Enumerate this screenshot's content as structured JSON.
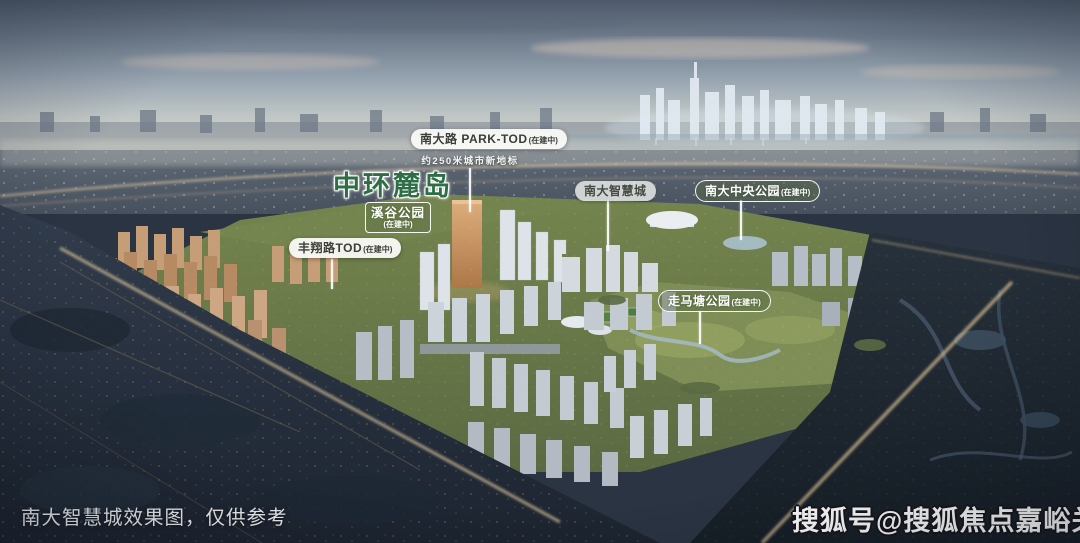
{
  "scene": {
    "caption": "南大智慧城效果图，仅供参考",
    "watermark": "搜狐号@搜狐焦点嘉峪关站"
  },
  "labels": {
    "park_tod": {
      "title": "南大路 PARK-TOD",
      "status": "(在建中)",
      "subtitle": "约250米城市新地标"
    },
    "zhonghuan_ludao": {
      "title": "中环麓岛"
    },
    "xigu_park": {
      "title": "溪谷公园",
      "status": "(在建中)"
    },
    "nanda_smart_city": {
      "title": "南大智慧城"
    },
    "nanda_central_park": {
      "title": "南大中央公园",
      "status": "(在建中)"
    },
    "fengxiang_tod": {
      "title": "丰翔路TOD",
      "status": "(在建中)"
    },
    "zoumatang_park": {
      "title": "走马塘公园",
      "status": "(在建中)"
    }
  },
  "colors": {
    "title_green": "#2e6e45",
    "pill_text": "#3a3d38",
    "park_label_bg": "rgba(88,104,66,0.48)",
    "sky_top": "#4e5a6b",
    "ground_green": "#6d7c4c",
    "dark_city": "#222c3a"
  }
}
